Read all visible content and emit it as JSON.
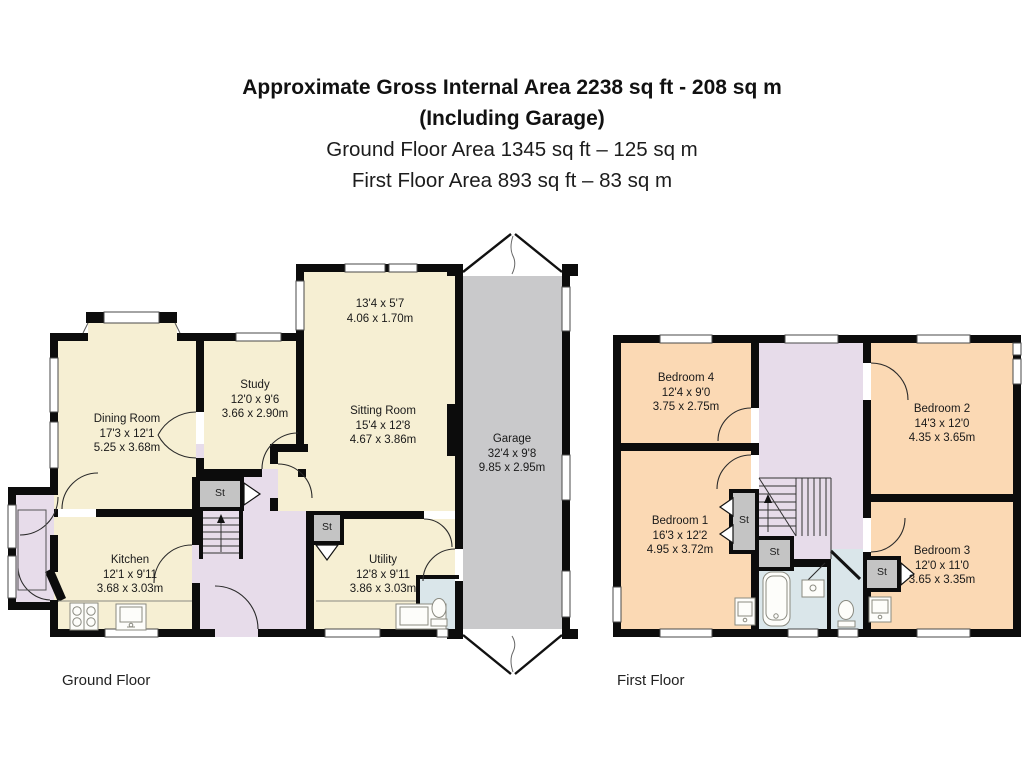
{
  "title": {
    "line1": "Approximate Gross Internal Area 2238 sq ft - 208 sq m",
    "line2": "(Including Garage)",
    "line3": "Ground Floor Area 1345 sq ft – 125 sq m",
    "line4": "First Floor Area 893 sq ft – 83 sq m"
  },
  "ground_floor": {
    "caption": "Ground Floor",
    "rooms": [
      {
        "name": "Dining Room",
        "imperial": "17'3 x 12'1",
        "metric": "5.25 x 3.68m"
      },
      {
        "name": "Study",
        "imperial": "12'0 x 9'6",
        "metric": "3.66 x 2.90m"
      },
      {
        "name": "Sitting Room",
        "imperial": "15'4 x 12'8",
        "metric": "4.67 x 3.86m"
      },
      {
        "name": "Garage",
        "imperial": "32'4 x 9'8",
        "metric": "9.85 x 2.95m"
      },
      {
        "name": "Kitchen",
        "imperial": "12'1 x 9'11",
        "metric": "3.68 x 3.03m"
      },
      {
        "name": "Utility",
        "imperial": "12'8 x 9'11",
        "metric": "3.86 x 3.03m"
      }
    ],
    "bay": {
      "imperial": "13'4 x 5'7",
      "metric": "4.06 x 1.70m"
    },
    "closets": [
      "St",
      "St"
    ]
  },
  "first_floor": {
    "caption": "First Floor",
    "rooms": [
      {
        "name": "Bedroom 4",
        "imperial": "12'4 x 9'0",
        "metric": "3.75 x 2.75m"
      },
      {
        "name": "Bedroom 2",
        "imperial": "14'3 x 12'0",
        "metric": "4.35 x 3.65m"
      },
      {
        "name": "Bedroom 1",
        "imperial": "16'3 x 12'2",
        "metric": "4.95 x 3.72m"
      },
      {
        "name": "Bedroom 3",
        "imperial": "12'0 x 11'0",
        "metric": "3.65 x 3.35m"
      }
    ],
    "closets": [
      "St",
      "St",
      "St"
    ]
  },
  "colors": {
    "wall": "#0c0c0c",
    "cream": "#f6efd3",
    "lavender": "#e7dcea",
    "peach": "#fbd9b4",
    "garage_grey": "#c9c9cb",
    "closet_grey": "#c4c4c4",
    "bath_blue": "#dae6ea"
  }
}
